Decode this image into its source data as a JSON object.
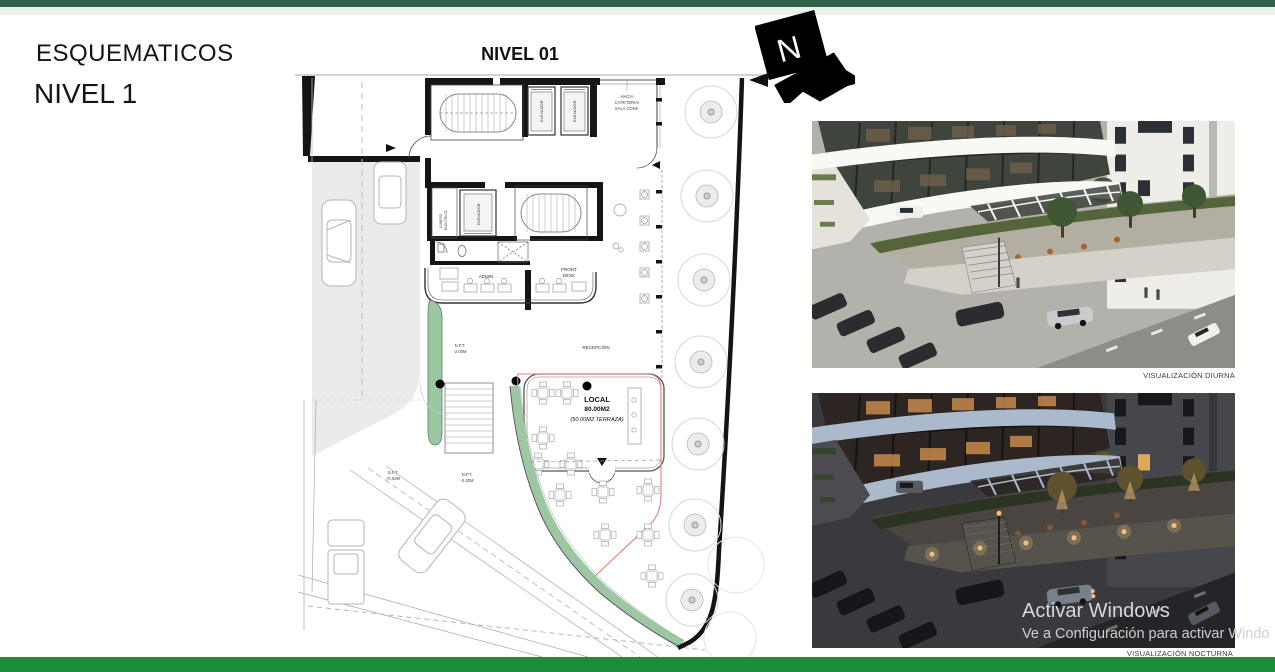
{
  "page": {
    "title1": "ESQUEMATICOS",
    "title2": "NIVEL 1",
    "plan_title": "NIVEL 01",
    "north": "N"
  },
  "plan": {
    "labels": {
      "hacia_l1": "HACIA",
      "hacia_l2": "CAFETERIA/",
      "hacia_l3": "SALA CONF.",
      "elevador": "ELEVADOR",
      "cuarto_l1": "CUARTO",
      "cuarto_l2": "ELECTRICO",
      "admin": "ADMIN",
      "front_l1": "FRONT",
      "front_l2": "DESK",
      "recepcion": "RECEPCIÓN",
      "npt2_l1": "N.P.T.",
      "npt2_l2": "-2.00M",
      "npt0_l1": "N.P.T.",
      "npt0_l2": "+0.00M",
      "npt020_l1": "N.P.T.",
      "npt020_l2": "-0.20M",
      "local_title": "LOCAL",
      "local_area": "80.00M2",
      "local_terraza": "(50.00M2 TERRAZA)"
    },
    "colors": {
      "wall": "#151515",
      "green_strip": "#9cc7a2",
      "red_outline": "#e2837a",
      "driveway": "#ebebeb"
    }
  },
  "renderings": [
    {
      "caption": "VISUALIZACIÓN DIURNA"
    },
    {
      "caption": "VISUALIZACIÓN NOCTURNA"
    }
  ],
  "watermark": {
    "line1": "Activar Windows",
    "line2": "Ve a Configuración para activar Windo"
  },
  "theme": {
    "top_bar": "#2f6247",
    "bottom_bar": "#1f8c3a",
    "header_strip": "#edefeb"
  }
}
